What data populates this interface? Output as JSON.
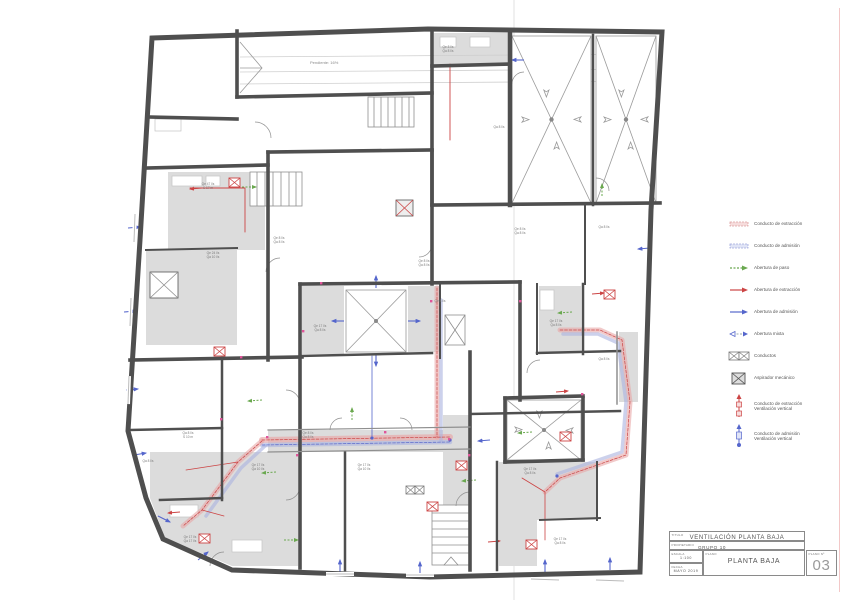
{
  "sheet": {
    "kind": "architectural ventilation floor plan"
  },
  "colors": {
    "wall": "#4f4f4f",
    "wet_room": "#dcdcdc",
    "extract_red": "#cc4444",
    "extract_band": "#e8a6a6",
    "admission_blue": "#5566cc",
    "admission_band": "#aab2e0",
    "pass_green": "#6aa84f",
    "door_dot": "#e0559a"
  },
  "plan": {
    "ramp_label": "Pendiente: 16%",
    "room_labels": [
      {
        "x": 208,
        "y": 183,
        "l1": "Qe 47 l/s",
        "l2": "S 17 m"
      },
      {
        "x": 213,
        "y": 252,
        "l1": "Qe 24 l/s",
        "l2": "Qa 10 l/s"
      },
      {
        "x": 279,
        "y": 237,
        "l1": "Qe 8 l/s",
        "l2": "Qa 8 l/s"
      },
      {
        "x": 320,
        "y": 325,
        "l1": "Qe 17 l/s",
        "l2": "Qa 8 l/s"
      },
      {
        "x": 424,
        "y": 260,
        "l1": "Qe 8 l/s",
        "l2": "Qa 8 l/s"
      },
      {
        "x": 448,
        "y": 46,
        "l1": "Qe 8 l/s",
        "l2": "Qa 8 l/s"
      },
      {
        "x": 499,
        "y": 126,
        "l1": "Qa 8 l/s",
        "l2": ""
      },
      {
        "x": 520,
        "y": 228,
        "l1": "Qe 8 l/s",
        "l2": "Qa 8 l/s"
      },
      {
        "x": 604,
        "y": 226,
        "l1": "Qa 8 l/s",
        "l2": ""
      },
      {
        "x": 556,
        "y": 320,
        "l1": "Qe 17 l/s",
        "l2": "Qa 8 l/s"
      },
      {
        "x": 604,
        "y": 358,
        "l1": "Qa 8 l/s",
        "l2": ""
      },
      {
        "x": 148,
        "y": 460,
        "l1": "Qa 8 l/s",
        "l2": ""
      },
      {
        "x": 188,
        "y": 432,
        "l1": "Qa 8 l/s",
        "l2": "S 10 m"
      },
      {
        "x": 258,
        "y": 464,
        "l1": "Qe 17 l/s",
        "l2": "Qa 10 l/s"
      },
      {
        "x": 308,
        "y": 432,
        "l1": "Qe 8 l/s",
        "l2": "Qa 8 l/s"
      },
      {
        "x": 364,
        "y": 464,
        "l1": "Qe 17 l/s",
        "l2": "Qa 10 l/s"
      },
      {
        "x": 440,
        "y": 300,
        "l1": "Qe 8 l/s",
        "l2": ""
      },
      {
        "x": 190,
        "y": 536,
        "l1": "Qe 17 l/s",
        "l2": "Qa 17 l/s"
      },
      {
        "x": 530,
        "y": 468,
        "l1": "Qe 17 l/s",
        "l2": "Qa 8 l/s"
      },
      {
        "x": 560,
        "y": 538,
        "l1": "Qe 17 l/s",
        "l2": "Qa 8 l/s"
      }
    ]
  },
  "legend": {
    "items": [
      {
        "symbol": "duct-red",
        "label": "Conducto de extracción"
      },
      {
        "symbol": "duct-blue",
        "label": "Conducto de admisión"
      },
      {
        "symbol": "arrow-green",
        "label": "Abertura de paso"
      },
      {
        "symbol": "arrow-red",
        "label": "Abertura de extracción"
      },
      {
        "symbol": "arrow-blue",
        "label": "Abertura de admisión"
      },
      {
        "symbol": "arrow-mixed",
        "label": "Abertura mixta"
      },
      {
        "symbol": "box-double",
        "label": "Conductos"
      },
      {
        "symbol": "box-x",
        "label": "Aspirador mecánico"
      },
      {
        "symbol": "riser-red",
        "label": "Conducto de extracción",
        "label2": "Ventilación vertical"
      },
      {
        "symbol": "riser-blue",
        "label": "Conducto de admisión",
        "label2": "Ventilación vertical"
      }
    ]
  },
  "titleblock": {
    "titulo_label": "TITULO",
    "titulo_value": "VENTILACIÓN PLANTA BAJA",
    "propietario_label": "PROPIETARIO",
    "propietario_value": "GRUPO 10",
    "escala_label": "ESCALA",
    "escala_value": "1:100",
    "fecha_label": "FECHA",
    "fecha_value": "MAYO 2019",
    "plano_label": "PLANO",
    "plano_value": "PLANTA BAJA",
    "plano_num_label": "PLANO Nº",
    "plano_num_value": "03"
  }
}
